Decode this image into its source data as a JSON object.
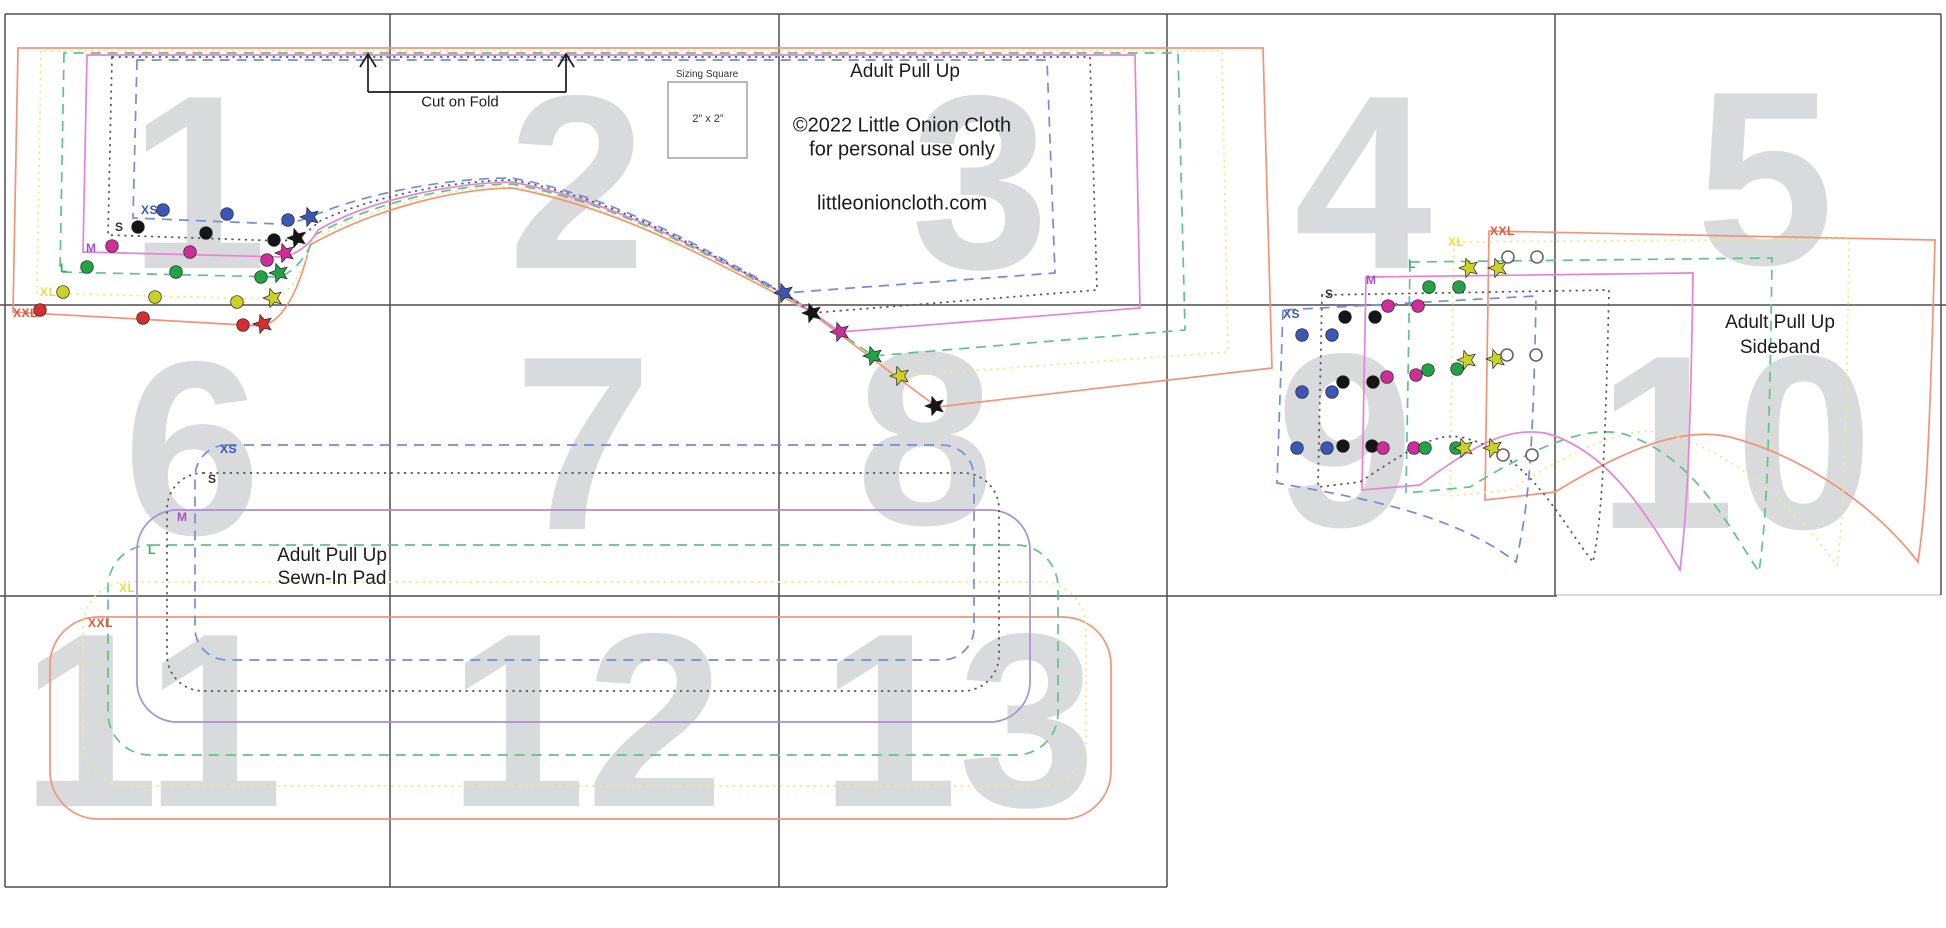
{
  "title": "Adult Pull Up",
  "copyright_line1": "©2022 Little Onion Cloth",
  "copyright_line2": "for personal use only",
  "website": "littleonioncloth.com",
  "fold_label": "Cut on Fold",
  "sizing_square": {
    "label": "Sizing Square",
    "dimensions": "2” x 2”"
  },
  "pad_piece_label": {
    "line1": "Adult Pull Up",
    "line2": "Sewn-In Pad"
  },
  "sideband_piece_label": {
    "line1": "Adult Pull Up",
    "line2": "Sideband"
  },
  "colors": {
    "page_number": "#d9dadc",
    "grid": "#4f4f4f",
    "open_marker_stroke": "#666666"
  },
  "sizes": [
    {
      "key": "xs",
      "name": "XS",
      "label_color": "#3a56c4",
      "line_color": "#6f8fdc",
      "line_style": "dashed",
      "marker_color": "#3c56b8"
    },
    {
      "key": "s",
      "name": "S",
      "label_color": "#333333",
      "line_color": "#555555",
      "line_style": "dotted",
      "marker_color": "#151515"
    },
    {
      "key": "m",
      "name": "M",
      "label_color": "#a050c8",
      "line_color": "#e583d6",
      "pad_line_color": "#a98fd4",
      "line_style": "solid",
      "marker_color": "#cf2d9a"
    },
    {
      "key": "l",
      "name": "L",
      "label_color": "#3fae62",
      "line_color": "#5fc488",
      "line_style": "dashed",
      "marker_color": "#23a346"
    },
    {
      "key": "xl",
      "name": "XL",
      "label_color": "#e8df4a",
      "line_color": "#ecea82",
      "line_style": "dotted",
      "marker_color": "#c9d225"
    },
    {
      "key": "xxl",
      "name": "XXL",
      "label_color": "#e5543a",
      "line_color": "#f29478",
      "line_style": "solid",
      "marker_color": "#d32f2f"
    }
  ],
  "pages": [
    {
      "n": "1",
      "x": 198,
      "y": 182
    },
    {
      "n": "2",
      "x": 577,
      "y": 182
    },
    {
      "n": "3",
      "x": 980,
      "y": 182
    },
    {
      "n": "4",
      "x": 1363,
      "y": 182
    },
    {
      "n": "5",
      "x": 1765,
      "y": 178
    },
    {
      "n": "6",
      "x": 192,
      "y": 448
    },
    {
      "n": "7",
      "x": 583,
      "y": 443
    },
    {
      "n": "8",
      "x": 925,
      "y": 438
    },
    {
      "n": "9",
      "x": 1345,
      "y": 440
    },
    {
      "n": "10",
      "x": 1735,
      "y": 442
    },
    {
      "n": "11",
      "x": 152,
      "y": 720
    },
    {
      "n": "12",
      "x": 586,
      "y": 720
    },
    {
      "n": "13",
      "x": 958,
      "y": 720
    }
  ],
  "size_labels": {
    "main": [
      {
        "size": "XS",
        "x": 141,
        "y": 214
      },
      {
        "size": "S",
        "x": 115,
        "y": 231
      },
      {
        "size": "M",
        "x": 86,
        "y": 252
      },
      {
        "size": "L",
        "x": 60,
        "y": 272
      },
      {
        "size": "XL",
        "x": 40,
        "y": 296
      },
      {
        "size": "XXL",
        "x": 13,
        "y": 317
      }
    ],
    "pad": [
      {
        "size": "XS",
        "x": 220,
        "y": 453
      },
      {
        "size": "S",
        "x": 208,
        "y": 483
      },
      {
        "size": "M",
        "x": 177,
        "y": 521
      },
      {
        "size": "L",
        "x": 148,
        "y": 554
      },
      {
        "size": "XL",
        "x": 119,
        "y": 592
      },
      {
        "size": "XXL",
        "x": 88,
        "y": 627
      }
    ],
    "sideband": [
      {
        "size": "XS",
        "x": 1283,
        "y": 318
      },
      {
        "size": "S",
        "x": 1325,
        "y": 298
      },
      {
        "size": "M",
        "x": 1366,
        "y": 284
      },
      {
        "size": "L",
        "x": 1408,
        "y": 268
      },
      {
        "size": "XL",
        "x": 1448,
        "y": 246
      },
      {
        "size": "XXL",
        "x": 1490,
        "y": 235
      }
    ]
  },
  "markers": [
    {
      "x": 163,
      "y": 210,
      "c": "xs",
      "t": "dot"
    },
    {
      "x": 227,
      "y": 214,
      "c": "xs",
      "t": "dot"
    },
    {
      "x": 288,
      "y": 220,
      "c": "xs",
      "t": "dot"
    },
    {
      "x": 138,
      "y": 227,
      "c": "s",
      "t": "dot"
    },
    {
      "x": 206,
      "y": 233,
      "c": "s",
      "t": "dot"
    },
    {
      "x": 274,
      "y": 240,
      "c": "s",
      "t": "dot"
    },
    {
      "x": 112,
      "y": 246,
      "c": "m",
      "t": "dot"
    },
    {
      "x": 190,
      "y": 252,
      "c": "m",
      "t": "dot"
    },
    {
      "x": 267,
      "y": 260,
      "c": "m",
      "t": "dot"
    },
    {
      "x": 87,
      "y": 267,
      "c": "l",
      "t": "dot"
    },
    {
      "x": 176,
      "y": 272,
      "c": "l",
      "t": "dot"
    },
    {
      "x": 261,
      "y": 277,
      "c": "l",
      "t": "dot"
    },
    {
      "x": 63,
      "y": 292,
      "c": "xl",
      "t": "dot"
    },
    {
      "x": 155,
      "y": 297,
      "c": "xl",
      "t": "dot"
    },
    {
      "x": 237,
      "y": 302,
      "c": "xl",
      "t": "dot"
    },
    {
      "x": 40,
      "y": 310,
      "c": "xxl",
      "t": "dot"
    },
    {
      "x": 143,
      "y": 318,
      "c": "xxl",
      "t": "dot"
    },
    {
      "x": 243,
      "y": 325,
      "c": "xxl",
      "t": "dot"
    },
    {
      "x": 310,
      "y": 217,
      "c": "xs",
      "t": "star"
    },
    {
      "x": 297,
      "y": 238,
      "c": "s",
      "t": "star"
    },
    {
      "x": 285,
      "y": 253,
      "c": "m",
      "t": "star"
    },
    {
      "x": 279,
      "y": 273,
      "c": "l",
      "t": "star"
    },
    {
      "x": 273,
      "y": 298,
      "c": "xl",
      "t": "star"
    },
    {
      "x": 263,
      "y": 324,
      "c": "xxl",
      "t": "star"
    },
    {
      "x": 784,
      "y": 293,
      "c": "xs",
      "t": "star"
    },
    {
      "x": 812,
      "y": 313,
      "c": "s",
      "t": "star"
    },
    {
      "x": 840,
      "y": 332,
      "c": "m",
      "t": "star"
    },
    {
      "x": 873,
      "y": 356,
      "c": "l",
      "t": "star"
    },
    {
      "x": 900,
      "y": 376,
      "c": "xl",
      "t": "star"
    },
    {
      "x": 935,
      "y": 406,
      "c": "s",
      "t": "star"
    },
    {
      "x": 1302,
      "y": 335,
      "c": "xs",
      "t": "dot"
    },
    {
      "x": 1332,
      "y": 335,
      "c": "xs",
      "t": "dot"
    },
    {
      "x": 1345,
      "y": 317,
      "c": "s",
      "t": "dot"
    },
    {
      "x": 1375,
      "y": 317,
      "c": "s",
      "t": "dot"
    },
    {
      "x": 1388,
      "y": 306,
      "c": "m",
      "t": "dot"
    },
    {
      "x": 1418,
      "y": 306,
      "c": "m",
      "t": "dot"
    },
    {
      "x": 1429,
      "y": 287,
      "c": "l",
      "t": "dot"
    },
    {
      "x": 1459,
      "y": 287,
      "c": "l",
      "t": "dot"
    },
    {
      "x": 1469,
      "y": 268,
      "c": "xl",
      "t": "star"
    },
    {
      "x": 1498,
      "y": 268,
      "c": "xl",
      "t": "star"
    },
    {
      "x": 1508,
      "y": 257,
      "c": "open",
      "t": "open"
    },
    {
      "x": 1537,
      "y": 257,
      "c": "open",
      "t": "open"
    },
    {
      "x": 1302,
      "y": 392,
      "c": "xs",
      "t": "dot"
    },
    {
      "x": 1332,
      "y": 392,
      "c": "xs",
      "t": "dot"
    },
    {
      "x": 1343,
      "y": 382,
      "c": "s",
      "t": "dot"
    },
    {
      "x": 1373,
      "y": 382,
      "c": "s",
      "t": "dot"
    },
    {
      "x": 1387,
      "y": 377,
      "c": "m",
      "t": "dot"
    },
    {
      "x": 1416,
      "y": 375,
      "c": "m",
      "t": "dot"
    },
    {
      "x": 1428,
      "y": 370,
      "c": "l",
      "t": "dot"
    },
    {
      "x": 1457,
      "y": 369,
      "c": "l",
      "t": "dot"
    },
    {
      "x": 1467,
      "y": 360,
      "c": "xl",
      "t": "star"
    },
    {
      "x": 1496,
      "y": 359,
      "c": "xl",
      "t": "star"
    },
    {
      "x": 1507,
      "y": 355,
      "c": "open",
      "t": "open"
    },
    {
      "x": 1536,
      "y": 355,
      "c": "open",
      "t": "open"
    },
    {
      "x": 1297,
      "y": 448,
      "c": "xs",
      "t": "dot"
    },
    {
      "x": 1327,
      "y": 448,
      "c": "xs",
      "t": "dot"
    },
    {
      "x": 1343,
      "y": 446,
      "c": "s",
      "t": "dot"
    },
    {
      "x": 1372,
      "y": 446,
      "c": "s",
      "t": "dot"
    },
    {
      "x": 1383,
      "y": 448,
      "c": "m",
      "t": "dot"
    },
    {
      "x": 1414,
      "y": 448,
      "c": "m",
      "t": "dot"
    },
    {
      "x": 1425,
      "y": 448,
      "c": "l",
      "t": "dot"
    },
    {
      "x": 1456,
      "y": 448,
      "c": "l",
      "t": "dot"
    },
    {
      "x": 1464,
      "y": 448,
      "c": "xl",
      "t": "star"
    },
    {
      "x": 1493,
      "y": 448,
      "c": "xl",
      "t": "star"
    },
    {
      "x": 1503,
      "y": 455,
      "c": "open",
      "t": "open"
    },
    {
      "x": 1532,
      "y": 455,
      "c": "open",
      "t": "open"
    }
  ]
}
